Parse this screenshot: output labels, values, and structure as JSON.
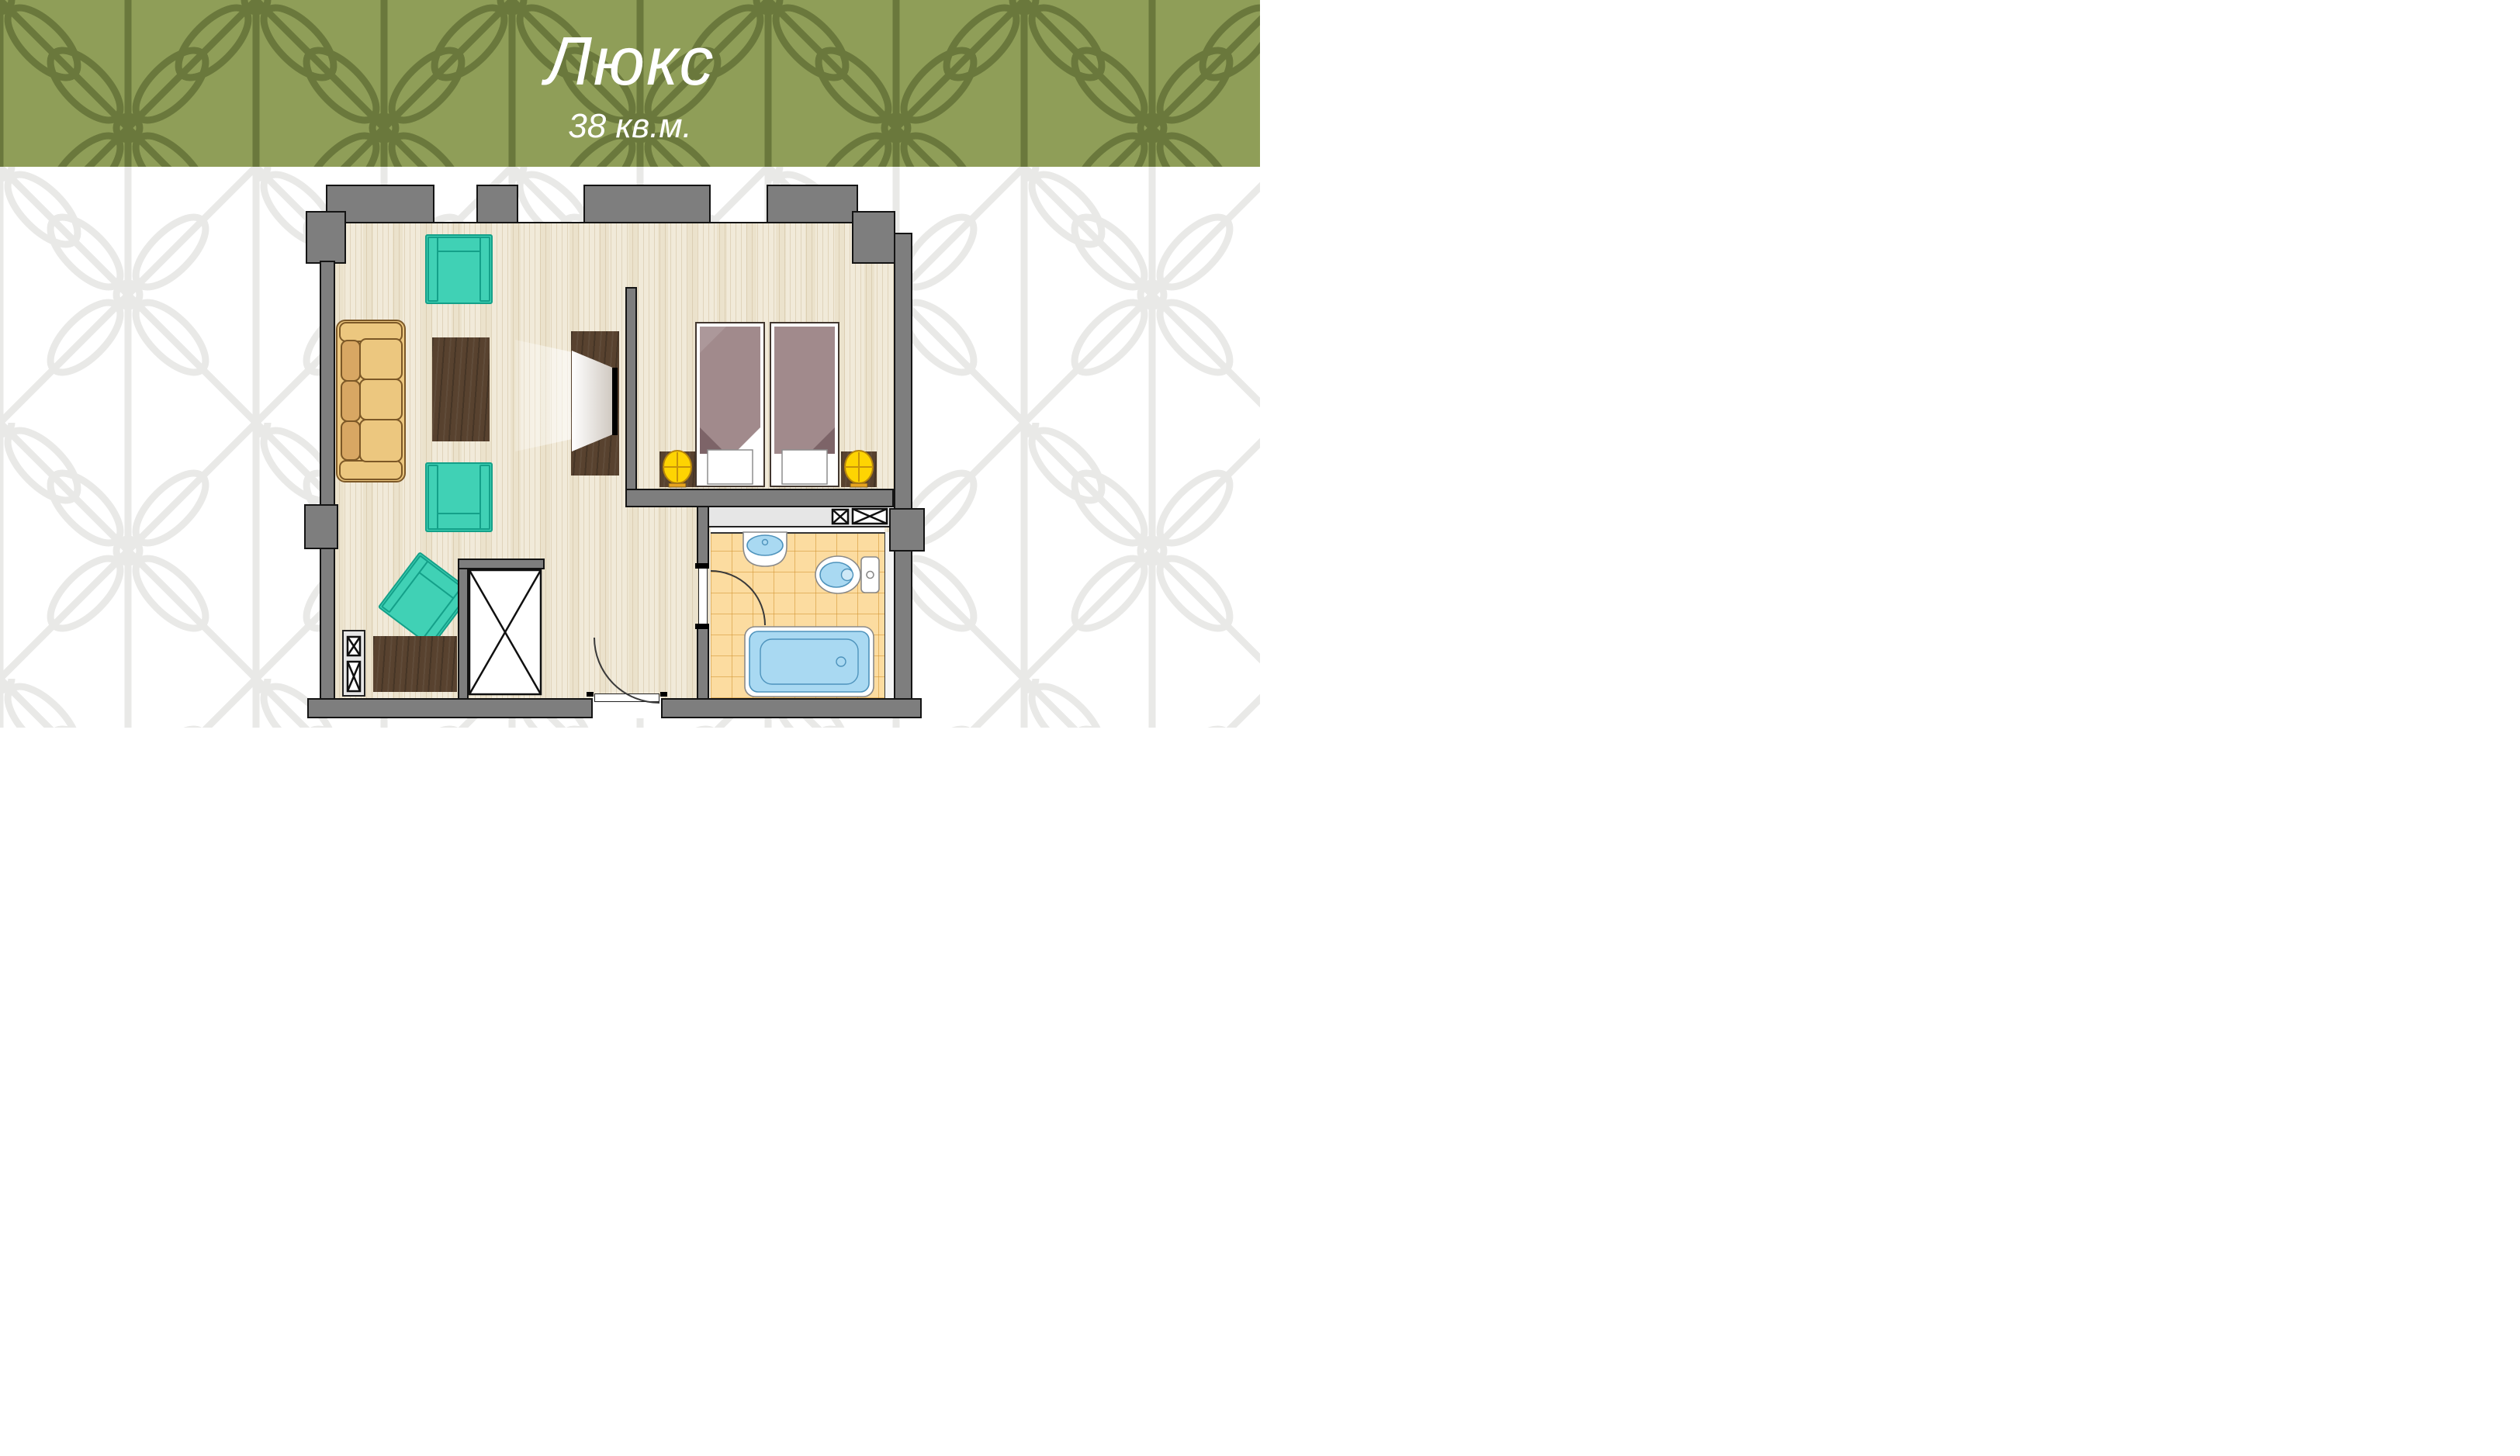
{
  "header": {
    "title": "Люкс",
    "subtitle": "38 кв.м."
  },
  "colors": {
    "pat-bg": "#8f9e58",
    "pat-fg": "#6a783c",
    "pat-faint": "#e9e9e7",
    "wall": "#7e7e7e",
    "outline": "#141414",
    "floor": "#f1ead9",
    "tile": "#fcdca0",
    "niche": "#e6e6e6",
    "teal": "#40d1b5",
    "teal-dark": "#14a089",
    "sofa": "#ecc77f",
    "sofa-dark": "#d8a763",
    "sofa-line": "#7c5827",
    "wood": "#58422f",
    "blanket": "#a18a8c",
    "blanket-dark": "#7d6468",
    "lamp": "#fed402",
    "lamp-base": "#e8a41f",
    "water": "#a9d9f2",
    "water-line": "#4e93bc"
  },
  "plan": {
    "rooms": [
      "living-room",
      "bedroom",
      "bathroom",
      "entry-hall"
    ],
    "furniture": [
      "sofa",
      "coffee-table",
      "armchair",
      "armchair",
      "armchair",
      "tv-cabinet",
      "desk",
      "wardrobe",
      "shelf-unit",
      "twin-bed",
      "twin-bed",
      "nightstand",
      "nightstand",
      "table-lamp",
      "table-lamp",
      "hall-closet",
      "sink",
      "toilet",
      "bathtub"
    ],
    "doors": [
      "entrance-door",
      "bathroom-door"
    ],
    "window_count": 3
  }
}
